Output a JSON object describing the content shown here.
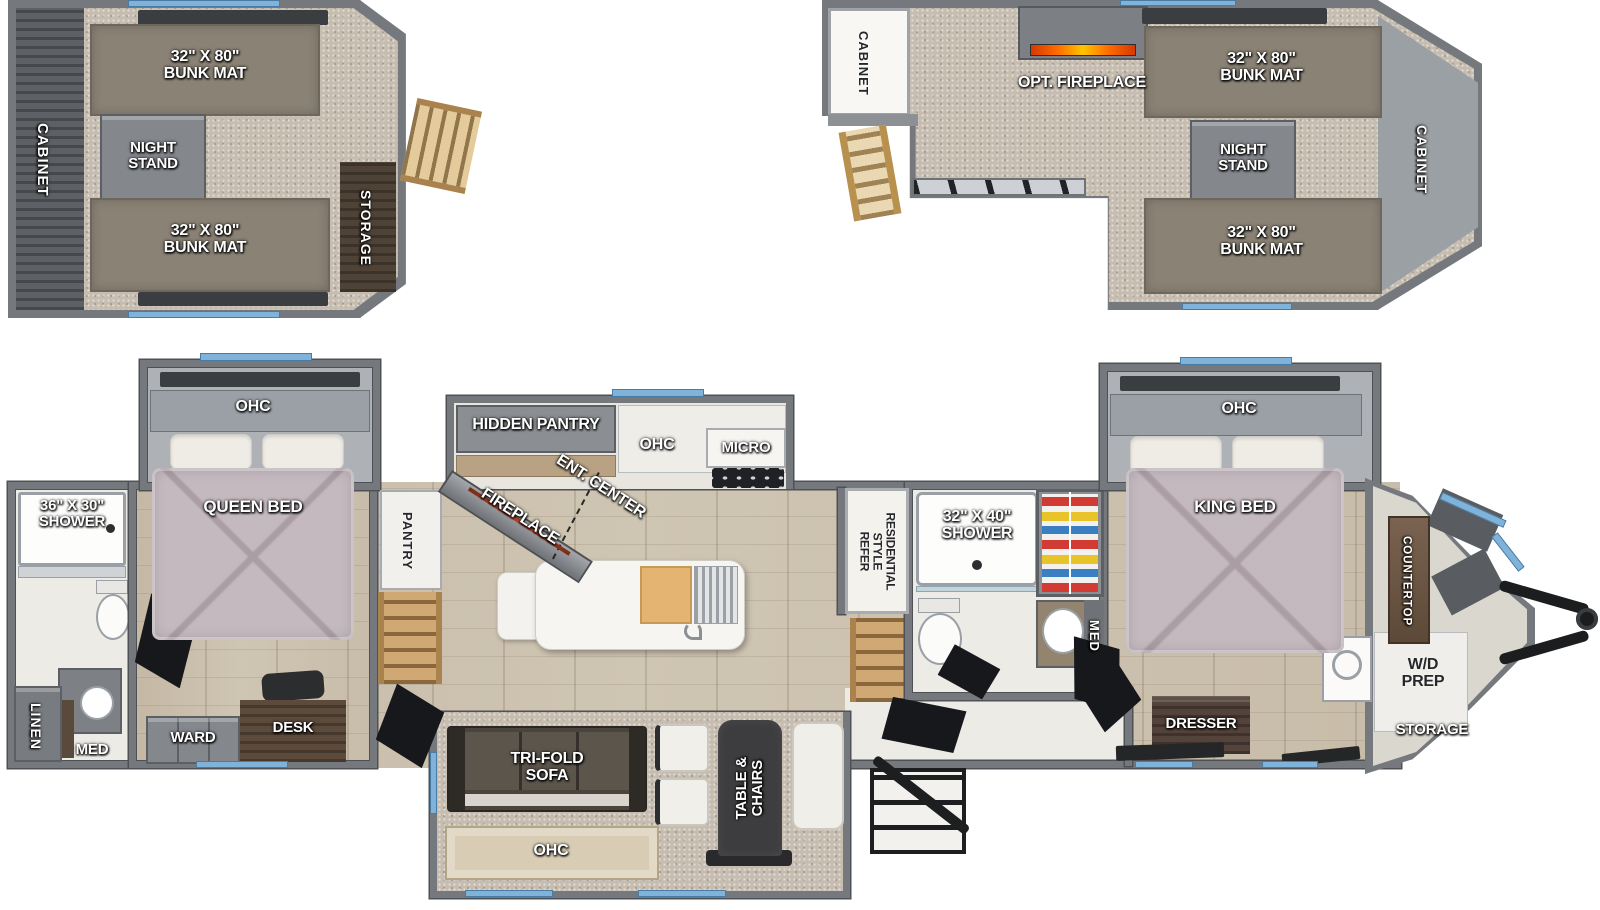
{
  "palette": {
    "wall": "#75797d",
    "wallD": "#4e5155",
    "carpet": "#c6bdb0",
    "wood": "#cfc5b3",
    "mat": "#8a8275",
    "bed": "#c4b9bf",
    "win": "#7fb3d9",
    "flame": "#ff6a00"
  },
  "loft_left": {
    "cabinet": "CABINET",
    "bunk_top": "32\" X 80\"\nBUNK MAT",
    "night_stand": "NIGHT\nSTAND",
    "bunk_bottom": "32\" X 80\"\nBUNK MAT",
    "storage": "STORAGE"
  },
  "loft_right": {
    "cabinet_rear": "CABINET",
    "opt_fireplace": "OPT. FIREPLACE",
    "bunk_top": "32\" X 80\"\nBUNK MAT",
    "night_stand": "NIGHT\nSTAND",
    "cabinet_front": "CABINET",
    "bunk_bottom": "32\" X 80\"\nBUNK MAT"
  },
  "rear_bath": {
    "shower": "36\" X 30\"\nSHOWER",
    "linen": "LINEN",
    "med": "MED"
  },
  "bedroom2": {
    "ohc": "OHC",
    "bed": "QUEEN BED",
    "ward": "WARD",
    "desk": "DESK"
  },
  "hall": {
    "pantry": "PANTRY"
  },
  "kitchen": {
    "hidden_pantry": "HIDDEN PANTRY",
    "ent_center": "ENT. CENTER",
    "fireplace": "FIREPLACE",
    "ohc": "OHC",
    "micro": "MICRO",
    "refer": "RESIDENTIAL\nSTYLE\nREFER"
  },
  "mid_bath": {
    "shower": "32\" X 40\"\nSHOWER",
    "med": "MED"
  },
  "bedroom1": {
    "ohc": "OHC",
    "bed": "KING BED",
    "dresser": "DRESSER",
    "countertop": "COUNTERTOP",
    "wd_prep": "W/D\nPREP",
    "storage": "STORAGE"
  },
  "slide_living": {
    "sofa": "TRI-FOLD\nSOFA",
    "ohc": "OHC",
    "table": "TABLE &\nCHAIRS"
  }
}
